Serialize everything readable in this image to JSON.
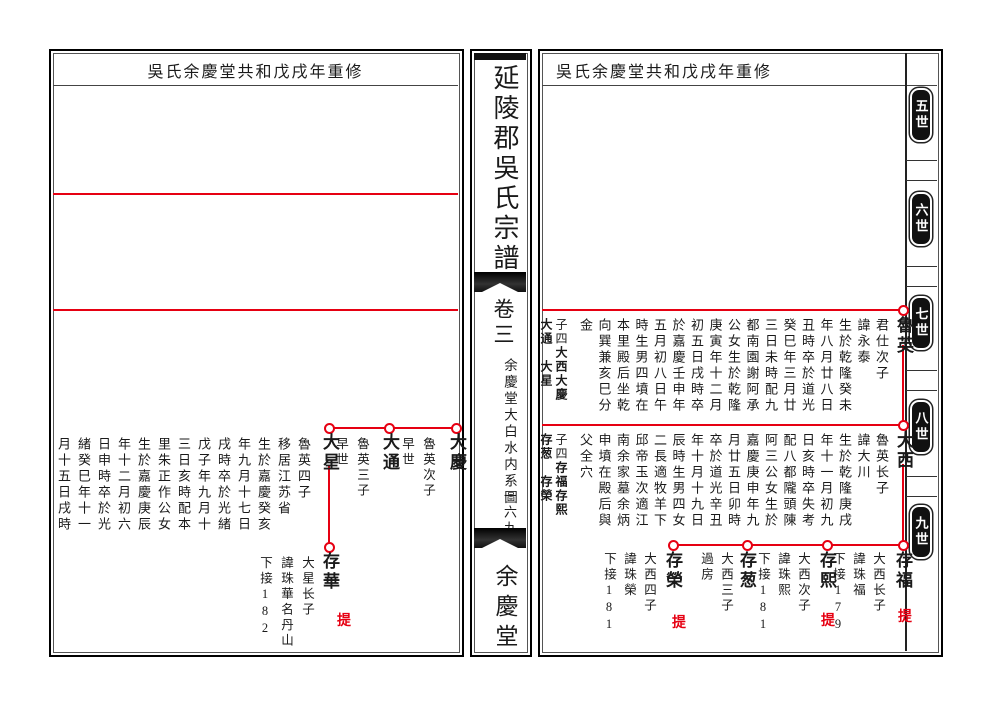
{
  "colors": {
    "line_red": "#e60012",
    "ink": "#1a1a1a"
  },
  "spine": {
    "title": "延陵郡吳氏宗譜",
    "volume": "卷三",
    "section": "余慶堂大白水内系圖",
    "folio": "一六九",
    "hall": "余慶堂"
  },
  "headers": {
    "left": "吳氏余慶堂共和戊戌年重修",
    "right": "吳氏余慶堂共和戊戌年重修"
  },
  "generation_tabs": [
    {
      "label": "五世"
    },
    {
      "label": "六世"
    },
    {
      "label": "七世"
    },
    {
      "label": "八世"
    },
    {
      "label": "九世"
    }
  ],
  "right_page": {
    "gen7": {
      "name": "魯英",
      "bio": [
        "君仕次子",
        "諱永泰",
        "生於乾隆癸未",
        "年八月廿八日",
        "丑時卒於道光",
        "癸巳年三月廿",
        "三日未時配九",
        "都南園謝阿承",
        "公女生於乾隆",
        "庚寅年十二月",
        "初五日戌時卒",
        "於嘉慶壬申年",
        "五月初八日午",
        "時生男四墳在",
        "本里殿后坐乾",
        "向巽兼亥巳分",
        "金"
      ],
      "sons_label": "子四",
      "sons_col_a": "大西大慶",
      "sons_col_b": "大通　大星"
    },
    "gen8": {
      "name": "大西",
      "bio": [
        "魯英长子",
        "諱大川",
        "生於乾隆庚戌",
        "年十一月初九",
        "日亥時卒失考",
        "配八都隴頭陳",
        "阿三公女生於",
        "嘉慶庚申年九",
        "月廿五日卯時",
        "卒於道光辛丑",
        "年十月十九日",
        "辰時生男四女",
        "二長適牧羊下",
        "邱帝玉次適江",
        "南余家墓余炳",
        "申墳在殿后與",
        "父全穴"
      ],
      "sons_label": "子四",
      "sons_col_a": "存福存熙",
      "sons_col_b": "存葱　存榮"
    },
    "gen9": [
      {
        "name": "存福",
        "info": [
          "大西长子",
          "諱珠福",
          "下接179"
        ],
        "mark": "提"
      },
      {
        "name": "存熙",
        "info": [
          "大西次子",
          "諱珠熙",
          "下接181"
        ],
        "mark": "提"
      },
      {
        "name": "存葱",
        "info": [
          "大西三子",
          "過房"
        ],
        "mark": ""
      },
      {
        "name": "存榮",
        "info": [
          "大西四子",
          "諱珠榮",
          "下接181"
        ],
        "mark": "提"
      }
    ]
  },
  "left_page": {
    "gen8": [
      {
        "name": "大慶",
        "info": [
          "魯英次子",
          "早世"
        ]
      },
      {
        "name": "大通",
        "info": [
          "魯英三子",
          "早世"
        ]
      },
      {
        "name": "大星",
        "info": [
          "魯英四子",
          "移居江苏省",
          "生於嘉慶癸亥",
          "年九月十七日",
          "戌時卒於光緒",
          "戊子年九月十",
          "三日亥時配本",
          "里朱正作公女",
          "生於嘉慶庚辰",
          "年十二月初六",
          "日申時卒於光",
          "緒癸巳年十一",
          "月十五日戌時"
        ]
      }
    ],
    "gen9": [
      {
        "name": "存華",
        "info": [
          "大星长子",
          "諱珠華名丹山",
          "下接182"
        ],
        "mark": "提"
      }
    ]
  }
}
